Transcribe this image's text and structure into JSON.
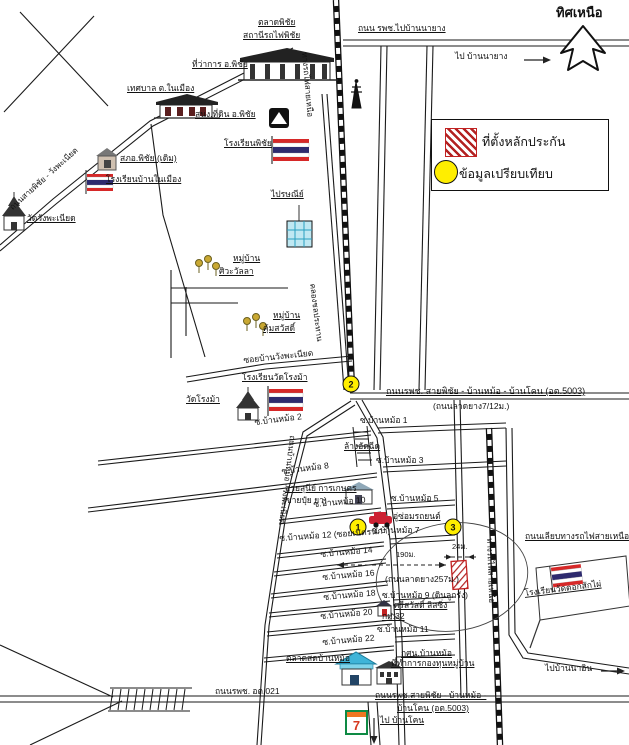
{
  "legend": {
    "collateral_label": "ที่ตั้งหลักประกัน",
    "comparison_label": "ข้อมูลเปรียบเทียบ"
  },
  "compass": {
    "north_label": "ทิศเหนือ"
  },
  "markers": {
    "one": "1",
    "two": "2",
    "three": "3"
  },
  "colors": {
    "ink": "#1a1a1a",
    "collateral_red": "#c22222",
    "marker_yellow": "#ffee00",
    "water_cyan": "#4ab8d8",
    "flag_red": "#d62828",
    "flag_blue": "#2d2a6e"
  },
  "labels": {
    "phichai_market": "ตลาดพิชัย",
    "phichai_station": "สถานีรถไฟพิชัย",
    "road_to_banayang": "ถนน รพช.ไปบ้านนายาง",
    "to_banayang": "ไป บ้านนายาง",
    "district_office": "ที่ว่าการ อ.พิชัย",
    "municipality": "เทศบาล ต.ในเมือง",
    "land_office": "สนง.ที่ดิน อ.พิชัย",
    "phichai_school": "โรงเรียนพิชัย",
    "old_police": "สภอ.พิชัย (เดิม)",
    "ban_nai_mueang_school": "โรงเรียนบ้านในเมือง",
    "wat_wang_phaniat": "วัดวังพะเนียด",
    "road_phichai_wangphaniat": "ถนนสายพิชัย - วังพะเนียด",
    "post_office": "ไปรษณีย์",
    "village1_line1": "หมู่บ้าน",
    "village1_line2": "ศิวะวัลลา",
    "village2_line1": "หมู่บ้าน",
    "village2_line2": "คุ้มสวัสดิ์",
    "soi_ban_wang_phaniat": "ซอยบ้านวังพะเนียด",
    "wat_rong_ma_school": "โรงเรียนวัดโรงม้า",
    "wat_rong_ma": "วัดโรงม้า",
    "road_5003": "ถนนรพช. สายพิชัย - บ้านหม้อ - บ้านโคน (อต.5003)",
    "road_5003_note": "(ถนนลาดยาง7/12ม.)",
    "railway_north_upper": "ทางรถไฟสายเหนือ",
    "irrigation_canal": "คลองชลประทาน",
    "railway_north_lower": "ทางรถไฟสายเหนือ",
    "road_along_railway": "ถนนเลียบทางรถไฟสายเหนือ",
    "road_banmo_wangphaniat": "ถนนบ้านหม้อ - วังพะเนียด",
    "soi1": "ซ.บ้านหม้อ 1",
    "soi2": "ซ.บ้านหม้อ 2",
    "soi3": "ซ.บ้านหม้อ 3",
    "soi5": "ซ.บ้านหม้อ 5",
    "soi7": "ซ.บ้านหม้อ 7",
    "soi8": "ซ.บ้านหม้อ 8",
    "soi9": "ซ.บ้านหม้อ 9 (ดินลูกรัง)",
    "soi10": "ซ.บ้านหม้อ 10",
    "soi11": "ซ.บ้านหม้อ 11",
    "soi12": "ซ.บ้านหม้อ 12 (ซอยเนตรนภา)",
    "soi14": "ซ.บ้านหม้อ 14",
    "soi16": "ซ.บ้านหม้อ 16",
    "soi18": "ซ.บ้านหม้อ 18",
    "soi20": "ซ.บ้านหม้อ 20",
    "soi22": "ซ.บ้านหม้อ 22",
    "car_wash": "ล้างอัดฉีด",
    "saisunee": "สายสุนีย์ การเกษตร",
    "saisunee_note": "(ขายปุ๋ย ยา)",
    "garage": "อู่ซ่อมรถยนต์",
    "dim_190": "190ม.",
    "dim_24": "24ม.",
    "paved_257": "(ถนนลาดยาง257ม.)",
    "srisawad": "ศรีสวัสดิ์ ลิสซิ่ง",
    "km32": "กม.32",
    "fresh_market": "ตลาดสดบ้านหม้อ",
    "nfe": "กศน.บ้านหม้อ",
    "village_fund": "ที่ทำการกองทุนหมู่บ้าน",
    "road_021": "ถนนรพช. อต.021",
    "road_5003_b1": "ถนนรพช.สายพิชัย - บ้านหม้อ -",
    "road_5003_b2": "บ้านโคน (อต.5003)",
    "to_ban_khon": "ไป บ้านโคน",
    "to_ban_na_in": "ไปบ้านนาอิน",
    "wat_doksak_school": "โรงเรียนวัดดอกสักไผ่",
    "seven_eleven": "7"
  }
}
